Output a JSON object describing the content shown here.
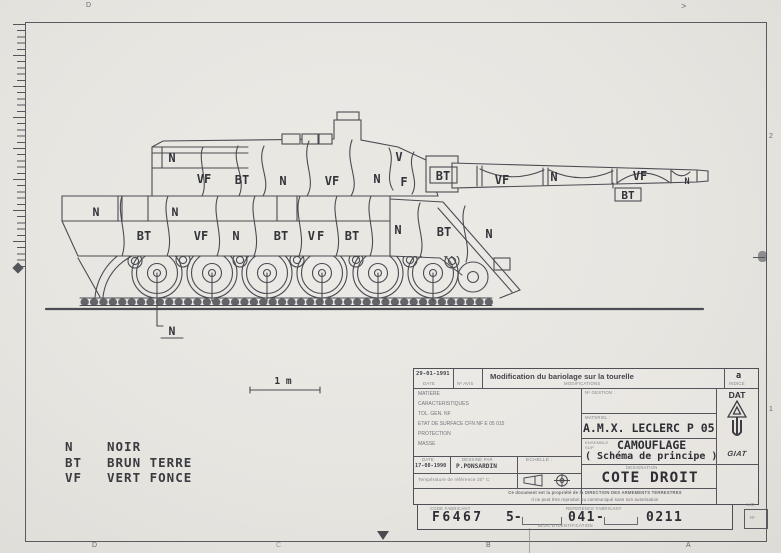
{
  "frame_markers": {
    "top_d": "D",
    "top_arrow": ">",
    "right_upper": "2",
    "right_lower": "1",
    "bottom_d": "D",
    "bottom_c": "C",
    "bottom_b": "B",
    "bottom_a": "A"
  },
  "drawing": {
    "camo_labels": [
      "N",
      "VF",
      "BT",
      "N",
      "VF",
      "N",
      "F",
      "V",
      "BT",
      "VF",
      "N",
      "VF",
      "N",
      "BT",
      "N",
      "N",
      "BT",
      "VF",
      "N",
      "BT",
      "VF",
      "BT",
      "N",
      "BT",
      "N",
      "N"
    ],
    "scale_label": "1 m",
    "legend": [
      {
        "abbr": "N",
        "name": "NOIR"
      },
      {
        "abbr": "BT",
        "name": "BRUN TERRE"
      },
      {
        "abbr": "VF",
        "name": "VERT FONCE"
      }
    ]
  },
  "title_block": {
    "revision": {
      "date": "29-01-1991",
      "date_label": "DATE",
      "avis_label": "Nº AVIS",
      "modification": "Modification du bariolage sur la tourelle",
      "modifications_label": "MODIFICATIONS",
      "indice": "a",
      "indice_label": "INDICE"
    },
    "specs": [
      "MATIERE",
      "CARACTERISTIQUES",
      "TOL. GEN. NF",
      "ETAT DE SURFACE CFN NF E 05 015",
      "PROTECTION",
      "MASSE"
    ],
    "issue": {
      "date_label": "DATE",
      "date": "17-08-1990",
      "drawn_label": "DESSINE PAR",
      "drawn_by": "P.PONSARDIN",
      "scale_label": "ECHELLE :",
      "temperature": "Température de référence 20° C"
    },
    "gestion_label": "Nº GESTION :",
    "materiel_label": "MATERIEL :",
    "materiel": "A.M.X. LECLERC  P 05",
    "ensemble_label": "ENSEMBLE SUP",
    "ensemble": "CAMOUFLAGE",
    "ensemble_sub": "( Schéma de principe )",
    "designation_label": "DESIGNATION",
    "designation": "COTE DROIT",
    "org": "DAT",
    "org_logo": "GIAT",
    "notice_line1": "Ce document est la propriété de la DIRECTION DES ARMEMENTS TERRESTRES",
    "notice_line2": "Il ne peut être reproduit ou communiqué sans son autorisation"
  },
  "id_block": {
    "code_label": "CODE FABRICANT",
    "code": "F6467",
    "ref_label": "REFERENCE FABRICANT",
    "ref_parts": [
      "5-",
      "041-",
      "0211"
    ],
    "bloc_label": "BLOC D'IDENTIFICATION",
    "lio": "LIO",
    "num_label": "Nº"
  }
}
